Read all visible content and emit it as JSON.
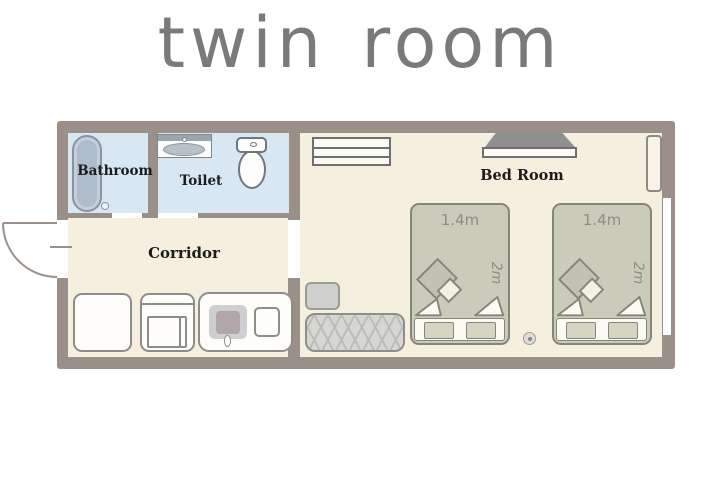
{
  "title": "twin room",
  "palette": {
    "wall": "#9a9089",
    "wet_floor": "#d9e7f3",
    "dry_floor": "#f4efdf",
    "bed_fill": "#cbcbbc",
    "outline": "#85857a",
    "title_text": "#7a7a7a",
    "label_text": "#1c1c1c",
    "dimension_text": "#8d8d81"
  },
  "rooms": {
    "bathroom": {
      "label": "Bathroom"
    },
    "toilet": {
      "label": "Toilet"
    },
    "corridor": {
      "label": "Corridor"
    },
    "bedroom": {
      "label": "Bed Room"
    }
  },
  "beds": [
    {
      "width_label": "1.4m",
      "length_label": "2m"
    },
    {
      "width_label": "1.4m",
      "length_label": "2m"
    }
  ]
}
